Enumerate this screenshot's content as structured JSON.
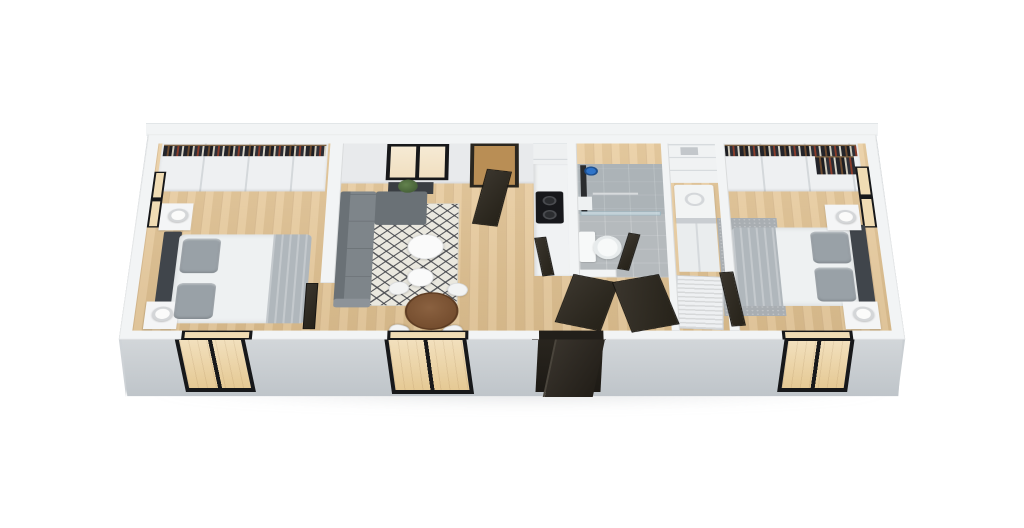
{
  "scene": {
    "type": "3d-floorplan-render",
    "description": "Top-down 3D dollhouse rendering of a long rectangular two-bedroom modular home, viewed from above at a slight angle on a plain white background",
    "view": "top-down perspective, front (lower) exterior wall and left/right gable walls visible in gray",
    "visible_text": "none"
  },
  "colors": {
    "background": "#ffffff",
    "wall-face": "#ccd1d5",
    "wall-face-dark": "#bfc5c9",
    "wall-cap": "#f2f4f5",
    "wall-inner": "#e8eaec",
    "floor-wood": "#e7c795",
    "rug-base": "#eae8df",
    "rug-line": "#43464b",
    "sofa": "#7e858a",
    "sofa-dark": "#6a7176",
    "sofa-light": "#8d9399",
    "headboard": "#40454b",
    "bed-linen": "#eef1f2",
    "bed-blanket": "#b0b7bc",
    "pillow": "#99a1a7",
    "table-wood": "#7a5233",
    "chair": "#f2f3f3",
    "door-dark": "#2e2a24",
    "frame-black": "#17181a",
    "glass-warm": "#f0dcb4",
    "tile": "#b5babd",
    "tile-dark": "#aab0b4",
    "shower-glass": "#cfe2ea",
    "accent-blue": "#2f74c9",
    "appliance": "#f2f4f4",
    "plant": "#4f6d3e",
    "clothes-bg": "#23242a",
    "shadow": "#dfe3e6"
  },
  "building": {
    "shape": "long horizontal rectangle",
    "rooms": [
      {
        "id": "bedroom-left",
        "label": "Bedroom 1 (left)",
        "furniture": [
          "double bed with white duvet and gray foot blanket",
          "dark headboard on left wall",
          "two white nightstands with cylindrical lamps",
          "built-in wardrobe with hanging clothes along back wall",
          "black-framed sliding window in front wall",
          "black-framed window in left wall",
          "dark sliding door"
        ]
      },
      {
        "id": "living-dining",
        "label": "Living / dining room",
        "furniture": [
          "L-shaped gray sectional sofa",
          "dark console with potted plant",
          "cream rug with dark diamond lattice pattern",
          "round white coffee table",
          "small round white side table",
          "round walnut dining table",
          "four white chairs",
          "black-framed window in back wall",
          "dark entry door in back wall standing open",
          "black-framed sliding glass door in front wall"
        ]
      },
      {
        "id": "kitchen",
        "label": "Galley kitchen",
        "furniture": [
          "white counter run",
          "black cooktop with two burners",
          "tall white partition cabinet"
        ]
      },
      {
        "id": "bathroom",
        "label": "Bathroom",
        "furniture": [
          "gray tile floor",
          "walk-in shower with glass screen",
          "black shower column",
          "blue shower-head accent",
          "white toilet",
          "dark door standing open"
        ]
      },
      {
        "id": "hallway",
        "label": "Entry hall",
        "furniture": [
          "dark front door swung outward through front wall",
          "second dark door leaf inside hall",
          "wood floor"
        ]
      },
      {
        "id": "utility",
        "label": "Utility closet",
        "furniture": [
          "white washer",
          "white shelving with storage box",
          "white louvered sliding doors"
        ]
      },
      {
        "id": "bedroom-right",
        "label": "Bedroom 2 (right)",
        "furniture": [
          "double bed with white duvet and gray blanket",
          "dark headboard on right wall",
          "two white nightstands with cylindrical lamps",
          "built-in wardrobe with hanging clothes along back wall",
          "gray area rug at foot of bed",
          "black-framed window in front wall",
          "black-framed window in right wall",
          "dark door"
        ]
      }
    ]
  }
}
